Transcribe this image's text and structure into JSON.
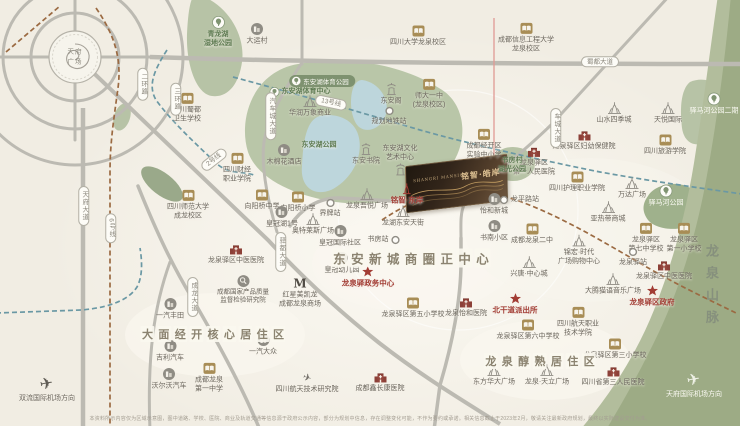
{
  "map": {
    "tianfu": {
      "line1": "天府",
      "line2": "广场"
    },
    "project": {
      "name": "铭智·皓岸",
      "name_en": "SHANGRI MANSION"
    },
    "mountain": "龙泉山脉",
    "disclaimer": "本资料所示内容仅为区域示意图，图中道路、学校、医院、商业及轨道交通等信息源于政府公示内容，部分为规划中信息，存在调整变化可能，不作为要约或承诺。相关信息截止于2023年2月，敬请关注最新政府规划，最终以实际建设交付为准。",
    "region_titles": [
      {
        "text": "大面经开核心居住区",
        "x": 213,
        "y": 334,
        "size": 11
      },
      {
        "text": "东安新城商圈正中心",
        "x": 411,
        "y": 258,
        "size": 12.5
      },
      {
        "text": "龙泉醇熟居住区",
        "x": 540,
        "y": 361,
        "size": 11
      }
    ],
    "road_labels": [
      {
        "text": "蜀都大道",
        "x": 600,
        "y": 62,
        "dir": "h"
      },
      {
        "text": "车城大道",
        "x": 556,
        "y": 128,
        "dir": "v"
      },
      {
        "text": "汽车城大道",
        "x": 271,
        "y": 116,
        "dir": "v"
      },
      {
        "text": "驿都大道",
        "x": 281,
        "y": 252,
        "dir": "v"
      },
      {
        "text": "成龙大道",
        "x": 193,
        "y": 297,
        "dir": "v"
      },
      {
        "text": "天府大道",
        "x": 84,
        "y": 206,
        "dir": "v"
      },
      {
        "text": "二环路",
        "x": 143,
        "y": 84,
        "dir": "v"
      },
      {
        "text": "三环路",
        "x": 176,
        "y": 99,
        "dir": "v"
      },
      {
        "text": "2号线",
        "x": 214,
        "y": 160,
        "dir": "r",
        "rot": -38
      },
      {
        "text": "13号线",
        "x": 331,
        "y": 103,
        "dir": "r",
        "rot": 12
      },
      {
        "text": "6号线",
        "x": 111,
        "y": 228,
        "dir": "v"
      }
    ],
    "landmarks": [
      {
        "t": "school",
        "x": 418,
        "y": 36,
        "l": [
          "四川大学龙泉校区"
        ]
      },
      {
        "t": "school",
        "x": 526,
        "y": 38,
        "l": [
          "成都信息工程大学",
          "龙泉校区"
        ]
      },
      {
        "t": "school",
        "x": 429,
        "y": 94,
        "l": [
          "师大一中",
          "(龙泉校区)"
        ]
      },
      {
        "t": "school",
        "x": 187,
        "y": 108,
        "l": [
          "四川蜀都",
          "卫生学校"
        ]
      },
      {
        "t": "school",
        "x": 237,
        "y": 168,
        "l": [
          "四川财经",
          "职业学院"
        ]
      },
      {
        "t": "school",
        "x": 188,
        "y": 205,
        "l": [
          "四川师范大学",
          "成龙校区"
        ]
      },
      {
        "t": "school",
        "x": 262,
        "y": 200,
        "l": [
          "向阳桥中学"
        ]
      },
      {
        "t": "school",
        "x": 298,
        "y": 202,
        "l": [
          "向阳桥小学"
        ]
      },
      {
        "t": "school",
        "x": 484,
        "y": 144,
        "l": [
          "成都经开区",
          "实验中小学"
        ]
      },
      {
        "t": "school",
        "x": 577,
        "y": 182,
        "l": [
          "四川护理职业学院"
        ]
      },
      {
        "t": "school",
        "x": 665,
        "y": 145,
        "l": [
          "四川旅游学院"
        ]
      },
      {
        "t": "school",
        "x": 532,
        "y": 234,
        "l": [
          "成都龙泉二中"
        ]
      },
      {
        "t": "school",
        "x": 646,
        "y": 238,
        "l": [
          "龙泉驿区",
          "第七中学校"
        ]
      },
      {
        "t": "school",
        "x": 684,
        "y": 238,
        "l": [
          "龙泉驿区",
          "第一小学校"
        ]
      },
      {
        "t": "school",
        "x": 413,
        "y": 308,
        "l": [
          "龙泉驿区第五小学校"
        ]
      },
      {
        "t": "school",
        "x": 209,
        "y": 378,
        "l": [
          "成都龙泉",
          "第一中学"
        ]
      },
      {
        "t": "school",
        "x": 528,
        "y": 330,
        "l": [
          "龙泉驿区第六中学校"
        ]
      },
      {
        "t": "school",
        "x": 578,
        "y": 322,
        "l": [
          "四川航天职业",
          "技术学院"
        ]
      },
      {
        "t": "school",
        "x": 615,
        "y": 349,
        "l": [
          "龙泉驿区第三小学校"
        ]
      },
      {
        "t": "hospital",
        "x": 584,
        "y": 140,
        "l": [
          "龙泉驿区妇幼保健院"
        ]
      },
      {
        "t": "hospital",
        "x": 534,
        "y": 161,
        "l": [
          "龙泉驿区",
          "第一人民医院"
        ]
      },
      {
        "t": "hospital",
        "x": 236,
        "y": 254,
        "l": [
          "龙泉驿区中医医院"
        ]
      },
      {
        "t": "hospital",
        "x": 664,
        "y": 270,
        "l": [
          "龙泉驿区中医医院"
        ]
      },
      {
        "t": "hospital",
        "x": 466,
        "y": 307,
        "l": [
          "龙泉怡和医院"
        ]
      },
      {
        "t": "hospital",
        "x": 380,
        "y": 382,
        "l": [
          "成都鑫长康医院"
        ]
      },
      {
        "t": "hospital",
        "x": 613,
        "y": 376,
        "l": [
          "四川省第三人民医院"
        ]
      },
      {
        "t": "star",
        "x": 368,
        "y": 277,
        "l": [
          "龙泉驿政务中心"
        ],
        "c": "red"
      },
      {
        "t": "star",
        "x": 515,
        "y": 304,
        "l": [
          "北干道派出所"
        ],
        "c": "red"
      },
      {
        "t": "star",
        "x": 652,
        "y": 296,
        "l": [
          "龙泉驿区政府"
        ],
        "c": "red"
      },
      {
        "t": "plaza",
        "x": 310,
        "y": 106,
        "l": [
          "华润万象商业"
        ]
      },
      {
        "t": "plaza",
        "x": 367,
        "y": 199,
        "l": [
          "龙泉吾悦广场"
        ]
      },
      {
        "t": "plaza",
        "x": 403,
        "y": 216,
        "l": [
          "龙湖东安天街"
        ]
      },
      {
        "t": "plaza",
        "x": 313,
        "y": 224,
        "l": [
          "奥特莱斯广场"
        ]
      },
      {
        "t": "plaza",
        "x": 632,
        "y": 188,
        "l": [
          "万达广场"
        ]
      },
      {
        "t": "plaza",
        "x": 608,
        "y": 212,
        "l": [
          "亚热带商城"
        ]
      },
      {
        "t": "plaza",
        "x": 579,
        "y": 250,
        "l": [
          "锦宏·时代",
          "广场购物中心"
        ]
      },
      {
        "t": "plaza",
        "x": 613,
        "y": 284,
        "l": [
          "大腾猫语音乐广场"
        ]
      },
      {
        "t": "plaza",
        "x": 494,
        "y": 375,
        "l": [
          "东方华大广场"
        ]
      },
      {
        "t": "plaza",
        "x": 547,
        "y": 375,
        "l": [
          "龙泉·天立广场"
        ]
      },
      {
        "t": "plaza",
        "x": 614,
        "y": 113,
        "l": [
          "山水四季城"
        ]
      },
      {
        "t": "plaza",
        "x": 668,
        "y": 113,
        "l": [
          "天悦国际"
        ]
      },
      {
        "t": "plaza",
        "x": 529,
        "y": 267,
        "l": [
          "兴唐·中心城"
        ]
      },
      {
        "t": "pagoda",
        "x": 391,
        "y": 94,
        "l": [
          "东安阁"
        ]
      },
      {
        "t": "pagoda",
        "x": 366,
        "y": 154,
        "l": [
          "东安书院"
        ]
      },
      {
        "t": "pagoda",
        "x": 400,
        "y": 160,
        "l": [
          "东安湖文化",
          "艺术中心"
        ],
        "above": true
      },
      {
        "t": "circle",
        "x": 284,
        "y": 155,
        "l": [
          "木棉花酒店"
        ]
      },
      {
        "t": "circle",
        "x": 257,
        "y": 34,
        "l": [
          "大运村"
        ]
      },
      {
        "t": "circle",
        "x": 494,
        "y": 204,
        "l": [
          "怡和新城"
        ]
      },
      {
        "t": "circle",
        "x": 494,
        "y": 231,
        "l": [
          "书南小区"
        ]
      },
      {
        "t": "circle",
        "x": 282,
        "y": 217,
        "l": [
          "皇冠湖1号"
        ]
      },
      {
        "t": "circle",
        "x": 340,
        "y": 236,
        "l": [
          "皇冠国际社区"
        ]
      },
      {
        "t": "circle",
        "x": 342,
        "y": 263,
        "l": [
          "皇冠幼儿园"
        ]
      },
      {
        "t": "circle",
        "x": 170,
        "y": 309,
        "l": [
          "一汽丰田"
        ]
      },
      {
        "t": "circle",
        "x": 170,
        "y": 351,
        "l": [
          "吉利汽车"
        ]
      },
      {
        "t": "circle",
        "x": 169,
        "y": 379,
        "l": [
          "沃尔沃汽车"
        ]
      },
      {
        "t": "circle",
        "x": 263,
        "y": 345,
        "l": [
          "一汽大众"
        ]
      },
      {
        "t": "magnifier",
        "x": 243,
        "y": 290,
        "l": [
          "成都国家产品质量",
          "监督检验研究院"
        ],
        "c": "sm"
      },
      {
        "t": "m",
        "x": 300,
        "y": 293,
        "l": [
          "红星美凯龙",
          "成都龙泉商场"
        ]
      },
      {
        "t": "plane-small",
        "x": 307,
        "y": 384,
        "l": [
          "四川航天技术研究院"
        ]
      },
      {
        "t": "station",
        "x": 389,
        "y": 116,
        "l": [
          "规划地铁站"
        ]
      },
      {
        "t": "station",
        "x": 330,
        "y": 208,
        "l": [
          "界牌站"
        ]
      },
      {
        "t": "station",
        "x": 384,
        "y": 240,
        "l": [
          "书房站"
        ],
        "side": "left"
      },
      {
        "t": "station",
        "x": 519,
        "y": 200,
        "l": [
          "龙平路站"
        ],
        "side": "right"
      },
      {
        "t": "station",
        "x": 633,
        "y": 257,
        "l": [
          "龙泉驿站"
        ]
      },
      {
        "t": "park",
        "x": 218,
        "y": 32,
        "l": [
          "青龙湖",
          "湿地公园"
        ],
        "c": "green"
      },
      {
        "t": "text-green",
        "x": 319,
        "y": 145,
        "l": [
          "东安湖公园"
        ],
        "c": "green"
      },
      {
        "t": "park",
        "x": 666,
        "y": 196,
        "l": [
          "驿马河公园"
        ],
        "c": "white"
      },
      {
        "t": "park",
        "x": 714,
        "y": 104,
        "l": [
          "驿马河公园二期"
        ],
        "c": "white"
      },
      {
        "t": "text-green",
        "x": 512,
        "y": 165,
        "l": [
          "书房村",
          "湖光公园"
        ],
        "c": "green"
      },
      {
        "t": "pill",
        "x": 322,
        "y": 81,
        "l": [
          "东安湖体育公园"
        ]
      },
      {
        "t": "park-s",
        "x": 300,
        "y": 92,
        "l": [
          "东安湖体育中心"
        ],
        "side": "right",
        "c": "green"
      },
      {
        "t": "plane",
        "x": 47,
        "y": 390,
        "l": [
          "双流国际机场方向"
        ]
      },
      {
        "t": "plane-light",
        "x": 694,
        "y": 386,
        "l": [
          "天府国际机场方向"
        ],
        "c": "white"
      },
      {
        "t": "project-marker",
        "x": 407,
        "y": 194,
        "l": [
          "铭智·东岸"
        ],
        "c": "red"
      }
    ]
  },
  "colors": {
    "accent_red": "#a23c34",
    "school_tan": "#a88d56",
    "hospital_red": "#8c4038",
    "park_green": "#7e9270",
    "map_bg": "#f1ede3",
    "road_grey": "#bcbab2",
    "metro_teal": "#6a98a4",
    "metro_brown": "#9b6a42"
  }
}
